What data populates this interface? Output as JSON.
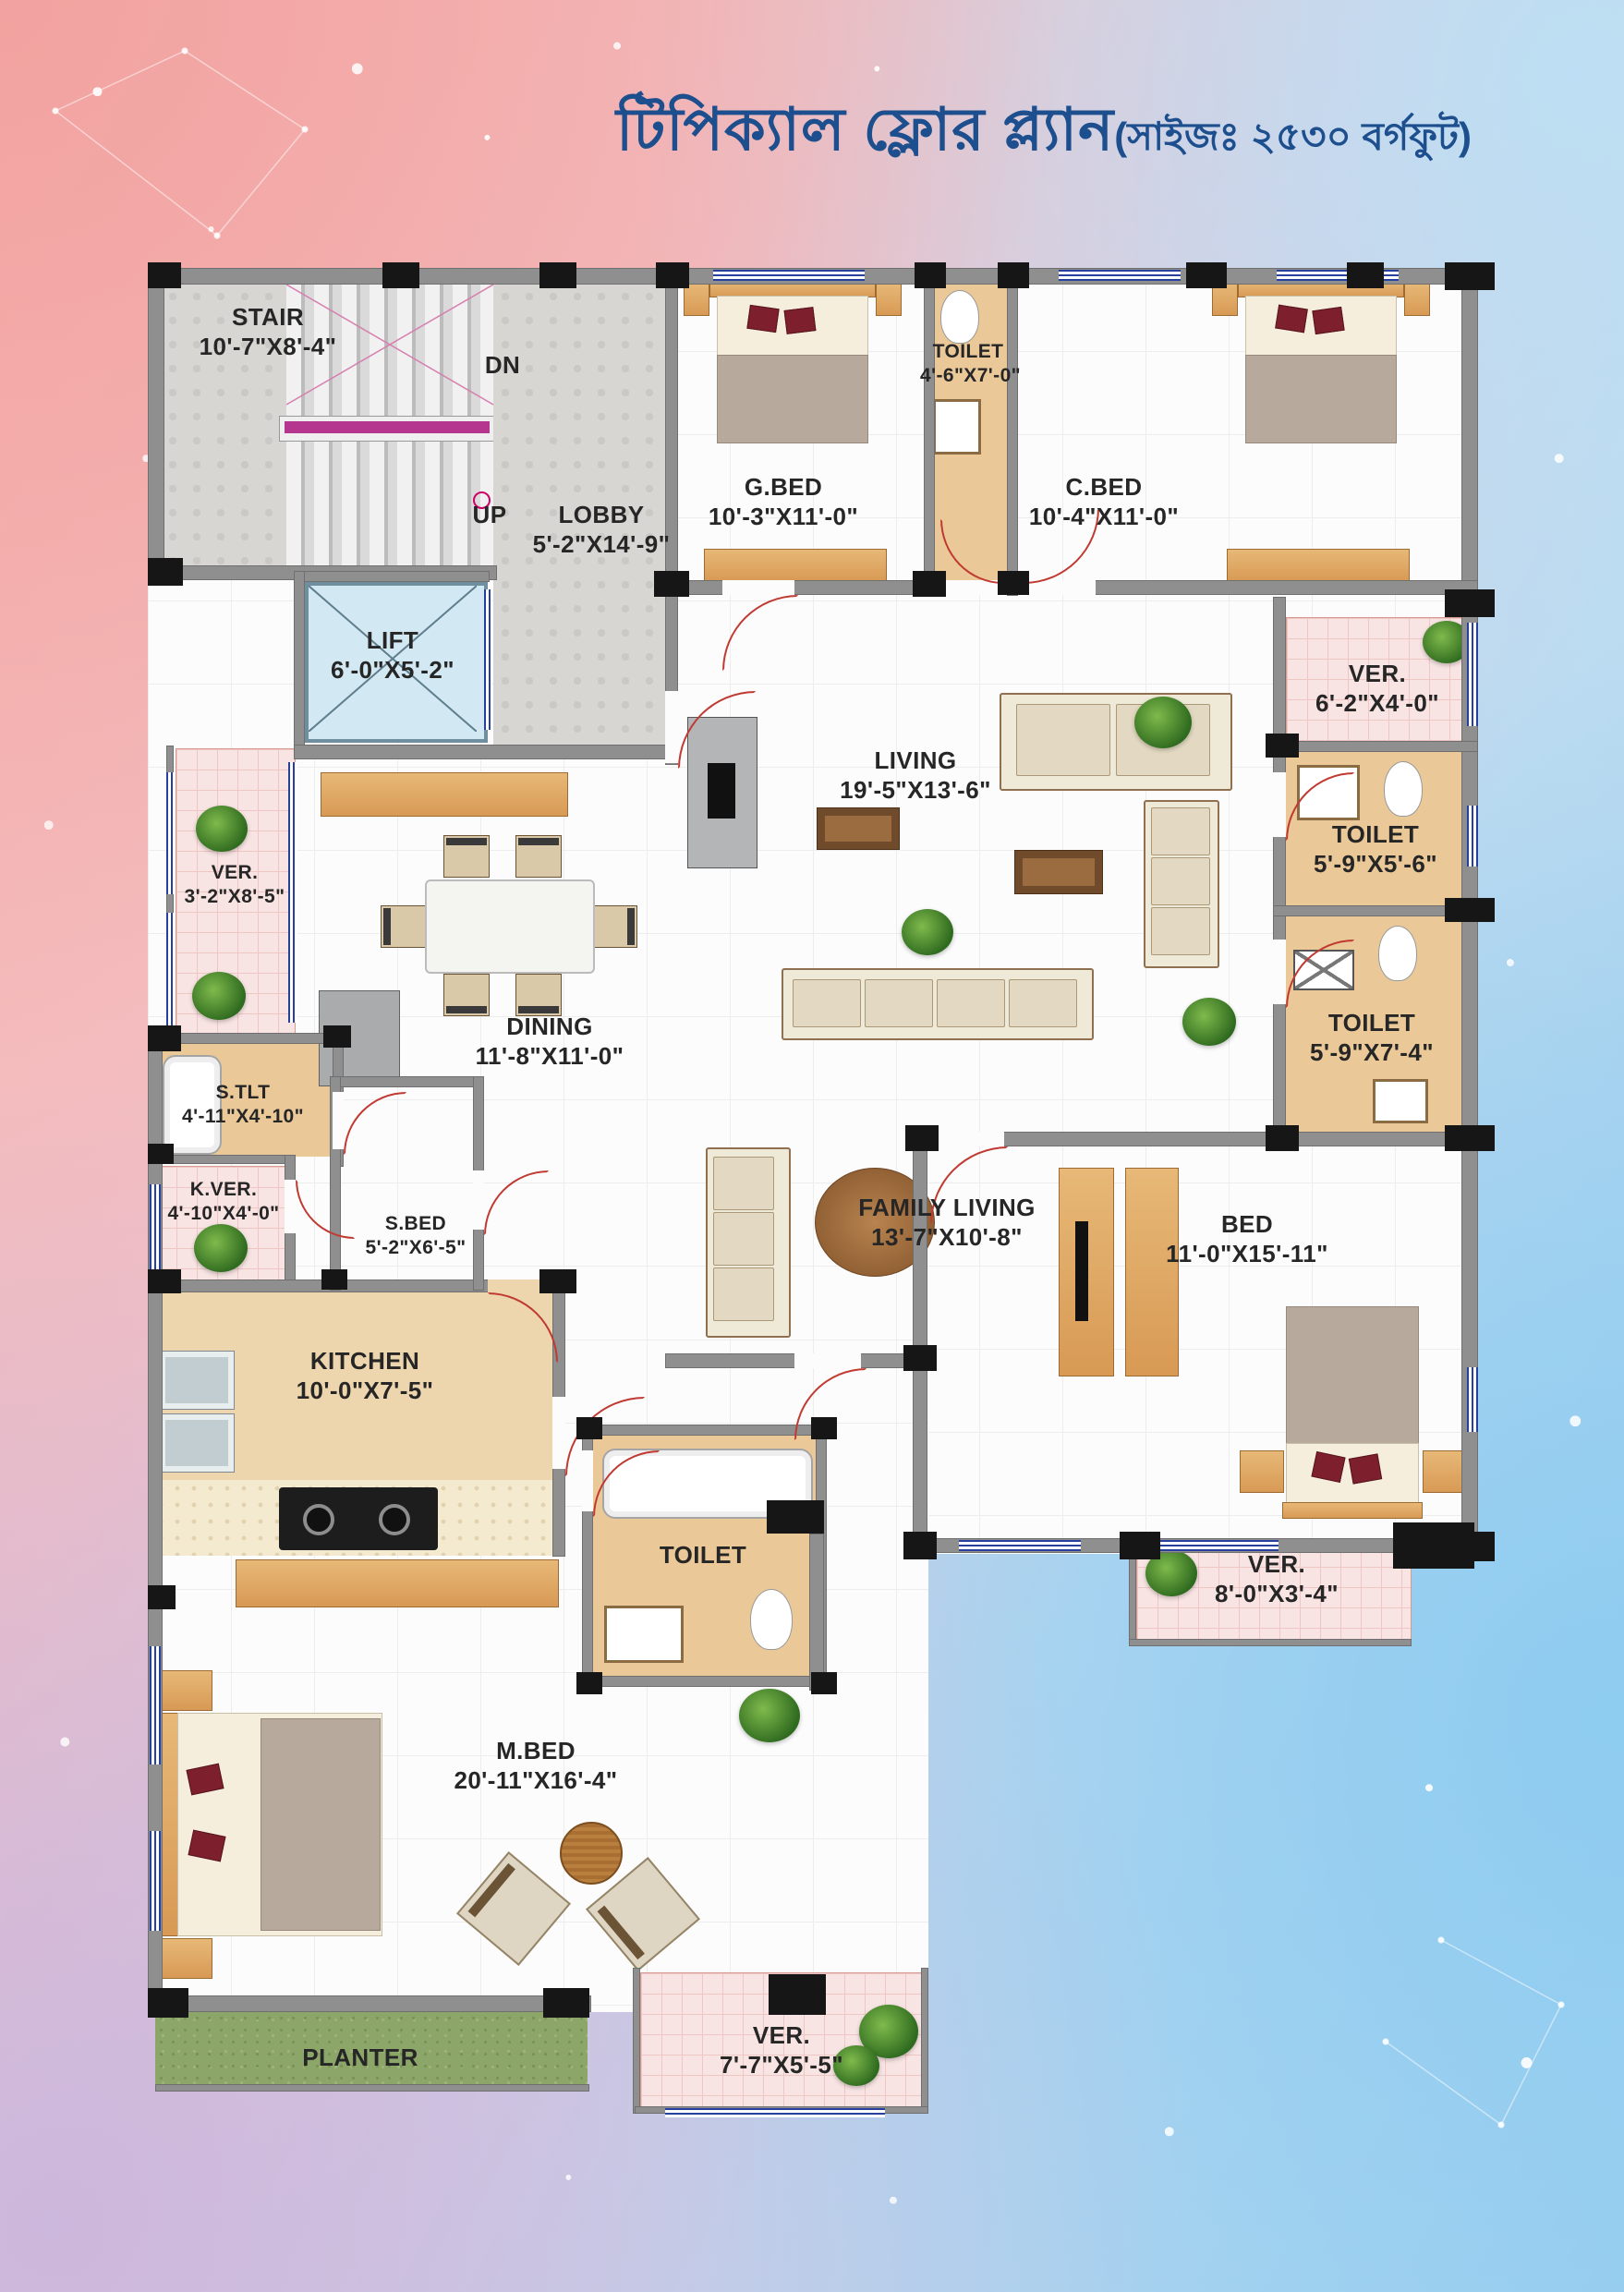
{
  "title": {
    "main": "টিপিক্যাল ফ্লোর প্ল্যান",
    "size_note": "(সাইজঃ ২৫৩০ বর্গফুট)"
  },
  "annotations": {
    "dn": "DN",
    "up": "UP"
  },
  "rooms": {
    "stair": {
      "label": "STAIR",
      "dims": "10'-7\"X8'-4\""
    },
    "lobby": {
      "label": "LOBBY",
      "dims": "5'-2\"X14'-9\""
    },
    "lift": {
      "label": "LIFT",
      "dims": "6'-0\"X5'-2\""
    },
    "gbed": {
      "label": "G.BED",
      "dims": "10'-3\"X11'-0\""
    },
    "toilet_top": {
      "label": "TOILET",
      "dims": "4'-6\"X7'-0\""
    },
    "cbed": {
      "label": "C.BED",
      "dims": "10'-4\"X11'-0\""
    },
    "ver_right": {
      "label": "VER.",
      "dims": "6'-2\"X4'-0\""
    },
    "toilet_r1": {
      "label": "TOILET",
      "dims": "5'-9\"X5'-6\""
    },
    "toilet_r2": {
      "label": "TOILET",
      "dims": "5'-9\"X7'-4\""
    },
    "living": {
      "label": "LIVING",
      "dims": "19'-5\"X13'-6\""
    },
    "dining": {
      "label": "DINING",
      "dims": "11'-8\"X11'-0\""
    },
    "ver_left": {
      "label": "VER.",
      "dims": "3'-2\"X8'-5\""
    },
    "stlt": {
      "label": "S.TLT",
      "dims": "4'-11\"X4'-10\""
    },
    "kver": {
      "label": "K.VER.",
      "dims": "4'-10\"X4'-0\""
    },
    "sbed": {
      "label": "S.BED",
      "dims": "5'-2\"X6'-5\""
    },
    "kitchen": {
      "label": "KITCHEN",
      "dims": "10'-0\"X7'-5\""
    },
    "family": {
      "label": "FAMILY LIVING",
      "dims": "13'-7\"X10'-8\""
    },
    "bed": {
      "label": "BED",
      "dims": "11'-0\"X15'-11\""
    },
    "mtoilet": {
      "label": "TOILET",
      "dims": ""
    },
    "mbed": {
      "label": "M.BED",
      "dims": "20'-11\"X16'-4\""
    },
    "ver_br": {
      "label": "VER.",
      "dims": "8'-0\"X3'-4\""
    },
    "ver_b": {
      "label": "VER.",
      "dims": "7'-7\"X5'-5\""
    },
    "planter": {
      "label": "PLANTER",
      "dims": ""
    }
  },
  "colors": {
    "title_blue": "#1d4f8e",
    "wall_gray": "#8f8f8f",
    "column_black": "#161616",
    "toilet_tan": "#eac898",
    "verandah_pink": "#f8e4e3",
    "planter_green": "#8ca568",
    "lift_blue": "#d2e9f3",
    "door_red": "#c03a32",
    "window_blue": "#27409e"
  }
}
